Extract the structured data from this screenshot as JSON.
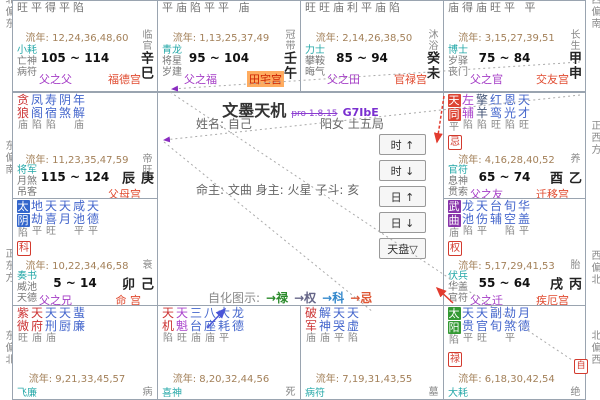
{
  "app": {
    "title": "文墨天机",
    "version": "pro 1.8.15",
    "code": "G7IbE"
  },
  "center": {
    "name_line": "姓名: 自己",
    "gender_line": "阳女 土五局",
    "master_line": "命主: 文曲 身主: 火星 子斗: 亥",
    "buttons": [
      {
        "label": "时 ↑"
      },
      {
        "label": "时 ↓"
      },
      {
        "label": "日 ↑"
      },
      {
        "label": "日 ↓"
      },
      {
        "label": "天盘▽"
      }
    ],
    "legend_title": "自化图示:",
    "legend_items": [
      {
        "label": "→禄",
        "color": "#2a8a2a"
      },
      {
        "label": "→权",
        "color": "#666688"
      },
      {
        "label": "→科",
        "color": "#3388cc"
      },
      {
        "label": "→忌",
        "color": "#dd5533"
      }
    ],
    "selfhua_marker": "自"
  },
  "compass": {
    "left": [
      {
        "text": "北偏东",
        "y": -6
      },
      {
        "text": "东偏南",
        "y": 140
      },
      {
        "text": "正东方",
        "y": 248
      },
      {
        "text": "东偏北",
        "y": 330
      }
    ],
    "right": [
      {
        "text": "西偏南",
        "y": -6
      },
      {
        "text": "正西方",
        "y": 120
      },
      {
        "text": "西偏北",
        "y": 250
      },
      {
        "text": "北偏西",
        "y": 330
      }
    ]
  },
  "star_colors": {
    "main": "#cc3333",
    "blue": "#4466cc",
    "purple": "#aa44cc",
    "dark": "#445577",
    "hl_blue": "#3366cc",
    "hl_green": "#339933",
    "hl_red": "#dd4433",
    "hl_purple": "#8833aa"
  },
  "palaces": [
    {
      "id": "si",
      "row": "top",
      "x": 12,
      "y": 0,
      "w": 146,
      "h": 92,
      "brightness_row": "旺平得平陷",
      "liunian": "流年: 12,24,36,48,60",
      "smalls": [
        "小耗",
        "亡神",
        "病符"
      ],
      "age": "105 ~ 114",
      "label_purple": "父之父",
      "label_red": "福德宫",
      "cs": "临官",
      "stem": "辛巳"
    },
    {
      "id": "wu",
      "row": "top",
      "x": 157,
      "y": 0,
      "w": 144,
      "h": 92,
      "brightness_row": "平庙陷平平 庙",
      "liunian": "流年: 1,13,25,37,49",
      "smalls": [
        "青龙",
        "将星",
        "岁建"
      ],
      "age": "95 ~ 104",
      "label_purple": "父之福",
      "label_red": "田宅宫",
      "label_red_hl": true,
      "cs": "冠带",
      "stem": "壬午"
    },
    {
      "id": "wei",
      "row": "top",
      "x": 300,
      "y": 0,
      "w": 144,
      "h": 92,
      "brightness_row": "旺旺庙利平庙陷",
      "liunian": "流年: 2,14,26,38,50",
      "smalls": [
        "力士",
        "攀鞍",
        "晦气"
      ],
      "age": "85 ~ 94",
      "label_purple": "父之田",
      "label_red": "官禄宫",
      "cs": "沐浴",
      "stem": "癸未"
    },
    {
      "id": "shen",
      "row": "top",
      "x": 443,
      "y": 0,
      "w": 143,
      "h": 92,
      "brightness_row": "庙得庙旺平 平",
      "liunian": "流年: 3,15,27,39,51",
      "smalls": [
        "博士",
        "岁驿",
        "丧门"
      ],
      "age": "75 ~ 84",
      "label_purple": "父之官",
      "label_red": "交友宫",
      "cs": "长生",
      "stem": "甲申"
    },
    {
      "id": "chen",
      "row": "mid",
      "x": 12,
      "y": 92,
      "w": 146,
      "h": 107,
      "stars": [
        {
          "n": "贪狼",
          "c": "main",
          "b": "庙"
        },
        {
          "n": "凤阁",
          "c": "blue",
          "b": "陷"
        },
        {
          "n": "寿宿",
          "c": "blue",
          "b": "陷"
        },
        {
          "n": "阴煞",
          "c": "blue",
          "b": ""
        },
        {
          "n": "年解",
          "c": "blue",
          "b": "庙"
        }
      ],
      "liunian": "流年: 11,23,35,47,59",
      "smalls": [
        "将军",
        "月煞",
        "吊客"
      ],
      "age": "115 ~ 124",
      "label_purple": "",
      "label_red": "父母宫",
      "cs": "帝旺",
      "stem": "庚辰"
    },
    {
      "id": "mao",
      "row": "mid",
      "x": 12,
      "y": 198,
      "w": 146,
      "h": 108,
      "stars": [
        {
          "n": "太阴",
          "hl": "hl_blue",
          "b": "陷"
        },
        {
          "n": "地劫",
          "c": "blue",
          "b": "平"
        },
        {
          "n": "天喜",
          "c": "blue",
          "b": "旺"
        },
        {
          "n": "天月",
          "c": "blue",
          "b": ""
        },
        {
          "n": "咸池",
          "c": "blue",
          "b": "平"
        },
        {
          "n": "天德",
          "c": "blue",
          "b": "平"
        }
      ],
      "badge": "科",
      "liunian": "流年: 10,22,34,46,58",
      "smalls": [
        "奏书",
        "威池",
        "天德"
      ],
      "age": "5 ~ 14",
      "label_purple": "父之兄",
      "label_red": "命 宫",
      "cs": "衰",
      "stem": "己卯"
    },
    {
      "id": "you",
      "row": "mid",
      "x": 443,
      "y": 92,
      "w": 143,
      "h": 107,
      "stars": [
        {
          "n": "天同",
          "hl": "hl_red",
          "b": "平"
        },
        {
          "n": "左辅",
          "c": "purple",
          "b": "陷"
        },
        {
          "n": "擎羊",
          "c": "dark",
          "b": "陷"
        },
        {
          "n": "红鸾",
          "c": "blue",
          "b": "旺"
        },
        {
          "n": "恩光",
          "c": "blue",
          "b": "陷"
        },
        {
          "n": "天才",
          "c": "blue",
          "b": "旺"
        }
      ],
      "badge": "忌",
      "liunian": "流年: 4,16,28,40,52",
      "smalls": [
        "官符",
        "息神",
        "贯索"
      ],
      "age": "65 ~ 74",
      "label_purple": "父之友",
      "label_red": "迁移宫",
      "cs": "养",
      "stem": "乙酉"
    },
    {
      "id": "xu",
      "row": "mid",
      "x": 443,
      "y": 198,
      "w": 143,
      "h": 108,
      "stars": [
        {
          "n": "武曲",
          "hl": "hl_purple",
          "b": "庙"
        },
        {
          "n": "龙池",
          "c": "blue",
          "b": "陷"
        },
        {
          "n": "天伤",
          "c": "blue",
          "b": "平"
        },
        {
          "n": "台辅",
          "c": "blue",
          "b": ""
        },
        {
          "n": "旬空",
          "c": "blue",
          "b": "陷"
        },
        {
          "n": "华盖",
          "c": "blue",
          "b": "平"
        }
      ],
      "badge": "权",
      "liunian": "流年: 5,17,29,41,53",
      "smalls": [
        "伏兵",
        "华盖",
        "官符"
      ],
      "age": "55 ~ 64",
      "label_purple": "父之迁",
      "label_red": "疾厄宫",
      "cs": "胎",
      "stem": "丙戌"
    },
    {
      "id": "yin",
      "row": "bottom",
      "x": 12,
      "y": 305,
      "w": 146,
      "h": 95,
      "stars": [
        {
          "n": "紫微",
          "c": "main",
          "b": "旺"
        },
        {
          "n": "天府",
          "c": "main",
          "b": "庙"
        },
        {
          "n": "天刑",
          "c": "blue",
          "b": "庙"
        },
        {
          "n": "天厨",
          "c": "blue",
          "b": ""
        },
        {
          "n": "蜚廉",
          "c": "blue",
          "b": ""
        }
      ],
      "liunian": "流年: 9,21,33,45,57",
      "smalls": [
        "飞廉"
      ],
      "cs": "病",
      "stem": ""
    },
    {
      "id": "chou",
      "row": "bottom",
      "x": 157,
      "y": 305,
      "w": 144,
      "h": 95,
      "stars": [
        {
          "n": "天机",
          "c": "main",
          "b": "陷"
        },
        {
          "n": "天魁",
          "c": "purple",
          "b": "旺"
        },
        {
          "n": "三台",
          "c": "blue",
          "b": "庙"
        },
        {
          "n": "八座",
          "c": "blue",
          "b": "庙"
        },
        {
          "n": "大耗",
          "c": "blue",
          "b": "平"
        },
        {
          "n": "龙德",
          "c": "blue",
          "b": ""
        }
      ],
      "liunian": "流年: 8,20,32,44,56",
      "smalls": [
        "喜神"
      ],
      "cs": "死",
      "stem": ""
    },
    {
      "id": "zi",
      "row": "bottom",
      "x": 300,
      "y": 305,
      "w": 144,
      "h": 95,
      "stars": [
        {
          "n": "破军",
          "c": "main",
          "b": "庙"
        },
        {
          "n": "解神",
          "c": "blue",
          "b": "庙"
        },
        {
          "n": "天哭",
          "c": "blue",
          "b": "平"
        },
        {
          "n": "天虚",
          "c": "blue",
          "b": "陷"
        }
      ],
      "liunian": "流年: 7,19,31,43,55",
      "smalls": [
        "病符"
      ],
      "cs": "墓",
      "stem": ""
    },
    {
      "id": "hai",
      "row": "bottom",
      "x": 443,
      "y": 305,
      "w": 143,
      "h": 95,
      "stars": [
        {
          "n": "太阳",
          "hl": "hl_green",
          "b": "陷"
        },
        {
          "n": "天贵",
          "c": "blue",
          "b": "平"
        },
        {
          "n": "天官",
          "c": "blue",
          "b": "旺"
        },
        {
          "n": "副旬",
          "c": "blue",
          "b": ""
        },
        {
          "n": "劫煞",
          "c": "blue",
          "b": "平"
        },
        {
          "n": "月德",
          "c": "blue",
          "b": ""
        }
      ],
      "badge": "禄",
      "liunian": "流年: 6,18,30,42,54",
      "smalls": [
        "大耗"
      ],
      "cs": "绝",
      "stem": ""
    }
  ]
}
